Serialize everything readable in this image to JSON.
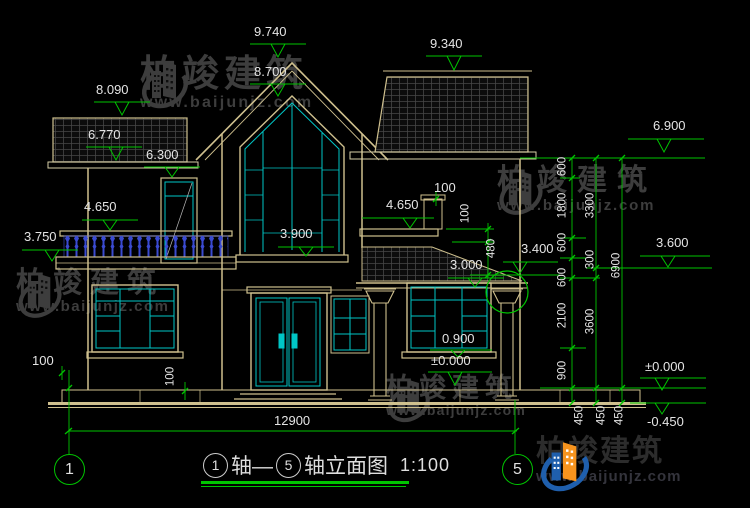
{
  "title": {
    "axis_start": "1",
    "connector": "轴—",
    "axis_end": "5",
    "suffix": "轴立面图",
    "scale": "1:100"
  },
  "axes": {
    "start": "1",
    "end": "5"
  },
  "levels": {
    "peak": "9.740",
    "gable_window_top": "8.700",
    "right_roof": "9.340",
    "left_roof": "8.090",
    "left_eave": "6.770",
    "floor2_door_top": "6.300",
    "balcony_rail": "4.650",
    "balcony_slab": "3.750",
    "gable_window_sill": "3.900",
    "right_ledge": "4.650",
    "right_eave": "6.900",
    "mid_level": "3.600",
    "porch_roof_top": "3.400",
    "porch_eave": "3.000",
    "window_sill": "0.900",
    "ground_floor": "±0.000",
    "ground_floor_right": "±0.000",
    "outdoor_ground": "-0.450"
  },
  "dims": {
    "total_width": "12900",
    "d100_axis": "100",
    "d100_plinth": "100",
    "d100_chimney": "100",
    "d100_ledge": "100",
    "d480_parapet": "480",
    "right_chain_inner": [
      "600",
      "1800",
      "600",
      "600",
      "2100",
      "900",
      "450"
    ],
    "right_chain_mid": [
      "3300",
      "300",
      "3600",
      "450"
    ],
    "right_chain_outer": [
      "6900",
      "450"
    ]
  },
  "watermark": {
    "brand": "柏竣建筑",
    "url": "www.baijunjz.com"
  },
  "colors": {
    "dim_green": "#00c400",
    "line_tan": "#cfc08e",
    "window_cyan": "#00c6c6",
    "baluster_blue": "#3a4ad0",
    "logo_blue": "#1f5fad",
    "logo_orange": "#f7941e"
  }
}
